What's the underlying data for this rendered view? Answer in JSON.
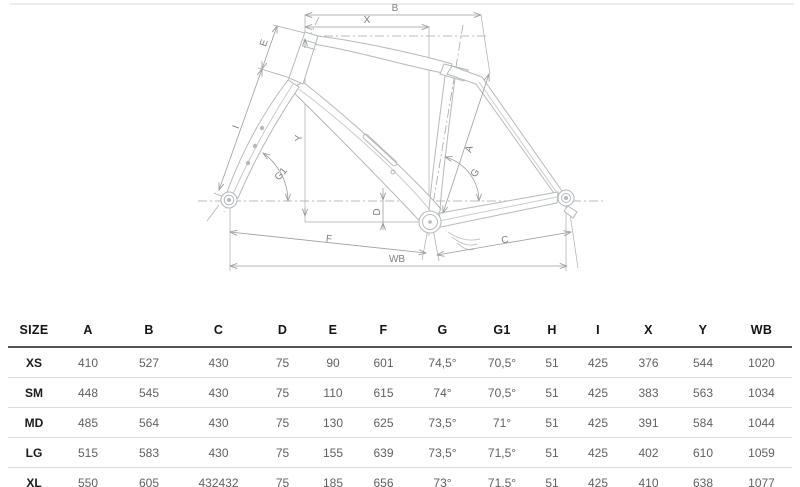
{
  "diagram": {
    "labels": {
      "b": "B",
      "x": "X",
      "e": "E",
      "i": "I",
      "y": "Y",
      "g1": "G1",
      "a": "A",
      "g": "G",
      "d": "D",
      "f": "F",
      "c": "C",
      "wb": "WB"
    },
    "colors": {
      "frame_line": "#b5b9bb",
      "frame_inner_line": "#c9cccd",
      "dimension_line": "#9a9ea0",
      "label_text": "#7d8184",
      "header_text": "#141414",
      "value_text": "#606060",
      "row_divider": "#dcdcdc",
      "header_rule": "#555555",
      "page_divider": "#ededed"
    }
  },
  "table": {
    "columns": [
      "SIZE",
      "A",
      "B",
      "C",
      "D",
      "E",
      "F",
      "G",
      "G1",
      "H",
      "I",
      "X",
      "Y",
      "WB"
    ],
    "rows": [
      {
        "size": "XS",
        "cells": [
          "410",
          "527",
          "430",
          "75",
          "90",
          "601",
          "74,5°",
          "70,5°",
          "51",
          "425",
          "376",
          "544",
          "1020"
        ]
      },
      {
        "size": "SM",
        "cells": [
          "448",
          "545",
          "430",
          "75",
          "110",
          "615",
          "74°",
          "70,5°",
          "51",
          "425",
          "383",
          "563",
          "1034"
        ]
      },
      {
        "size": "MD",
        "cells": [
          "485",
          "564",
          "430",
          "75",
          "130",
          "625",
          "73,5°",
          "71°",
          "51",
          "425",
          "391",
          "584",
          "1044"
        ]
      },
      {
        "size": "LG",
        "cells": [
          "515",
          "583",
          "430",
          "75",
          "155",
          "639",
          "73,5°",
          "71,5°",
          "51",
          "425",
          "402",
          "610",
          "1059"
        ]
      },
      {
        "size": "XL",
        "cells": [
          "550",
          "605",
          "432432",
          "75",
          "185",
          "656",
          "73°",
          "71,5°",
          "51",
          "425",
          "410",
          "638",
          "1077"
        ]
      }
    ]
  }
}
